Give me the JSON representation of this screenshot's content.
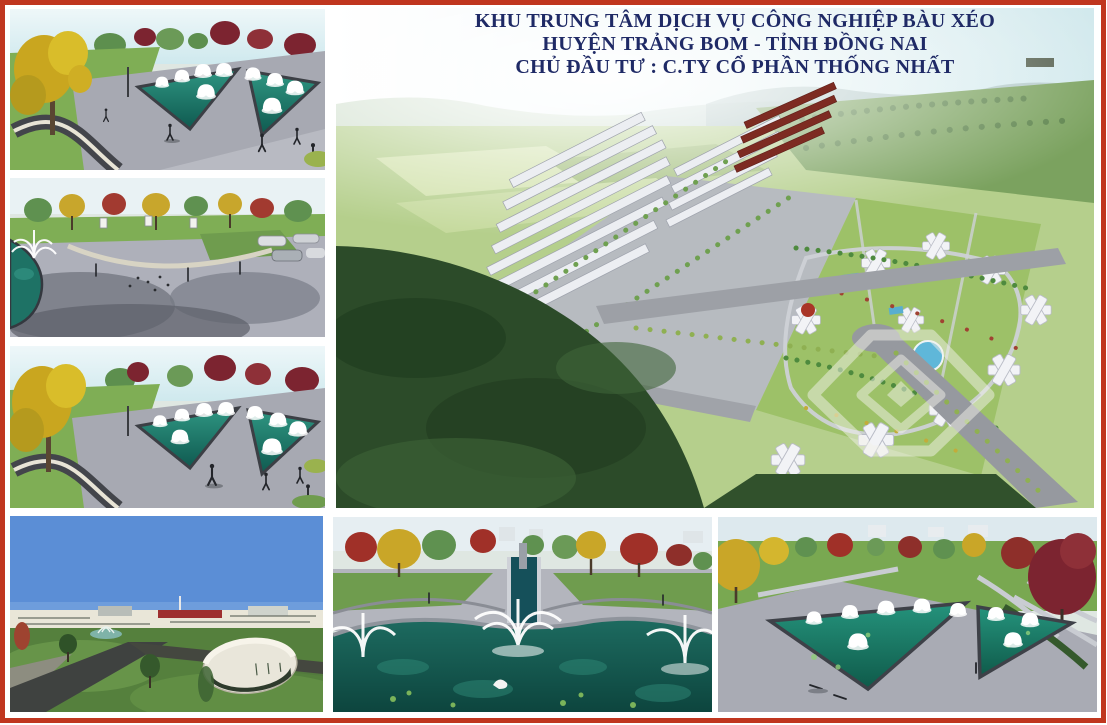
{
  "page": {
    "width": 1107,
    "height": 725,
    "background": "#ffffff",
    "frame_color": "#c0361f"
  },
  "header": {
    "line1": "KHU TRUNG TÂM DỊCH VỤ CÔNG NGHIỆP BÀU XÉO",
    "line2": "HUYỆN TRẢNG BOM - TỈNH ĐỒNG NAI",
    "line3": "CHỦ ĐẦU TƯ : C.TY CỔ PHẦN THỐNG NHẤT",
    "text_color": "#1f2a66"
  },
  "panels": [
    {
      "id": "park-triangular-fountains-view-1",
      "subject": "park with V-shaped teal fountain pools, yellow and maroon trees, curved walkway"
    },
    {
      "id": "plaza-fountain-view",
      "subject": "paved plaza with corner fountain pond, tree line, parked cars, pedestrians and pigeons"
    },
    {
      "id": "park-triangular-fountains-view-2",
      "subject": "second view of park with triangular fountain pools and walkway"
    },
    {
      "id": "masterplan-aerial-view",
      "subject": "aerial perspective of industrial service center: rowhouse blocks, apartment clusters, roads, ponds, green fields and hills"
    },
    {
      "id": "industrial-entry-view",
      "subject": "blue sky, long factory buildings on horizon, lawns, dark asphalt roads, oval pavilion building"
    },
    {
      "id": "pond-promenade-view",
      "subject": "foreground lily pond with fountain sprays and swan, water channel promenade, autumn trees"
    },
    {
      "id": "triangular-ponds-aerial-view",
      "subject": "elevated view of twin triangular fountain pools in gray plaza with large red tree"
    }
  ],
  "watermark": {
    "name": "nested-diamond-logo",
    "color": "#f2f2ea",
    "opacity": 0.5
  },
  "colors": {
    "frame_red": "#c0361f",
    "title_navy": "#1f2a66",
    "sky_haze": "#d6ebee",
    "sky_blue": "#5b8ed6",
    "pond_teal": "#1d6b60",
    "pool_teal_light": "#2a8a7a",
    "grass_green": "#7fae55",
    "field_green": "#b5cf8c",
    "forest_dark": "#2c4b29",
    "plaza_gray": "#adb0b9",
    "road_gray": "#96999f",
    "asphalt_dark": "#3f4240",
    "tree_yellow": "#c9a628",
    "tree_red": "#8e2f2a",
    "roof_maroon": "#7d2b22",
    "building_white": "#f0f0f4"
  }
}
